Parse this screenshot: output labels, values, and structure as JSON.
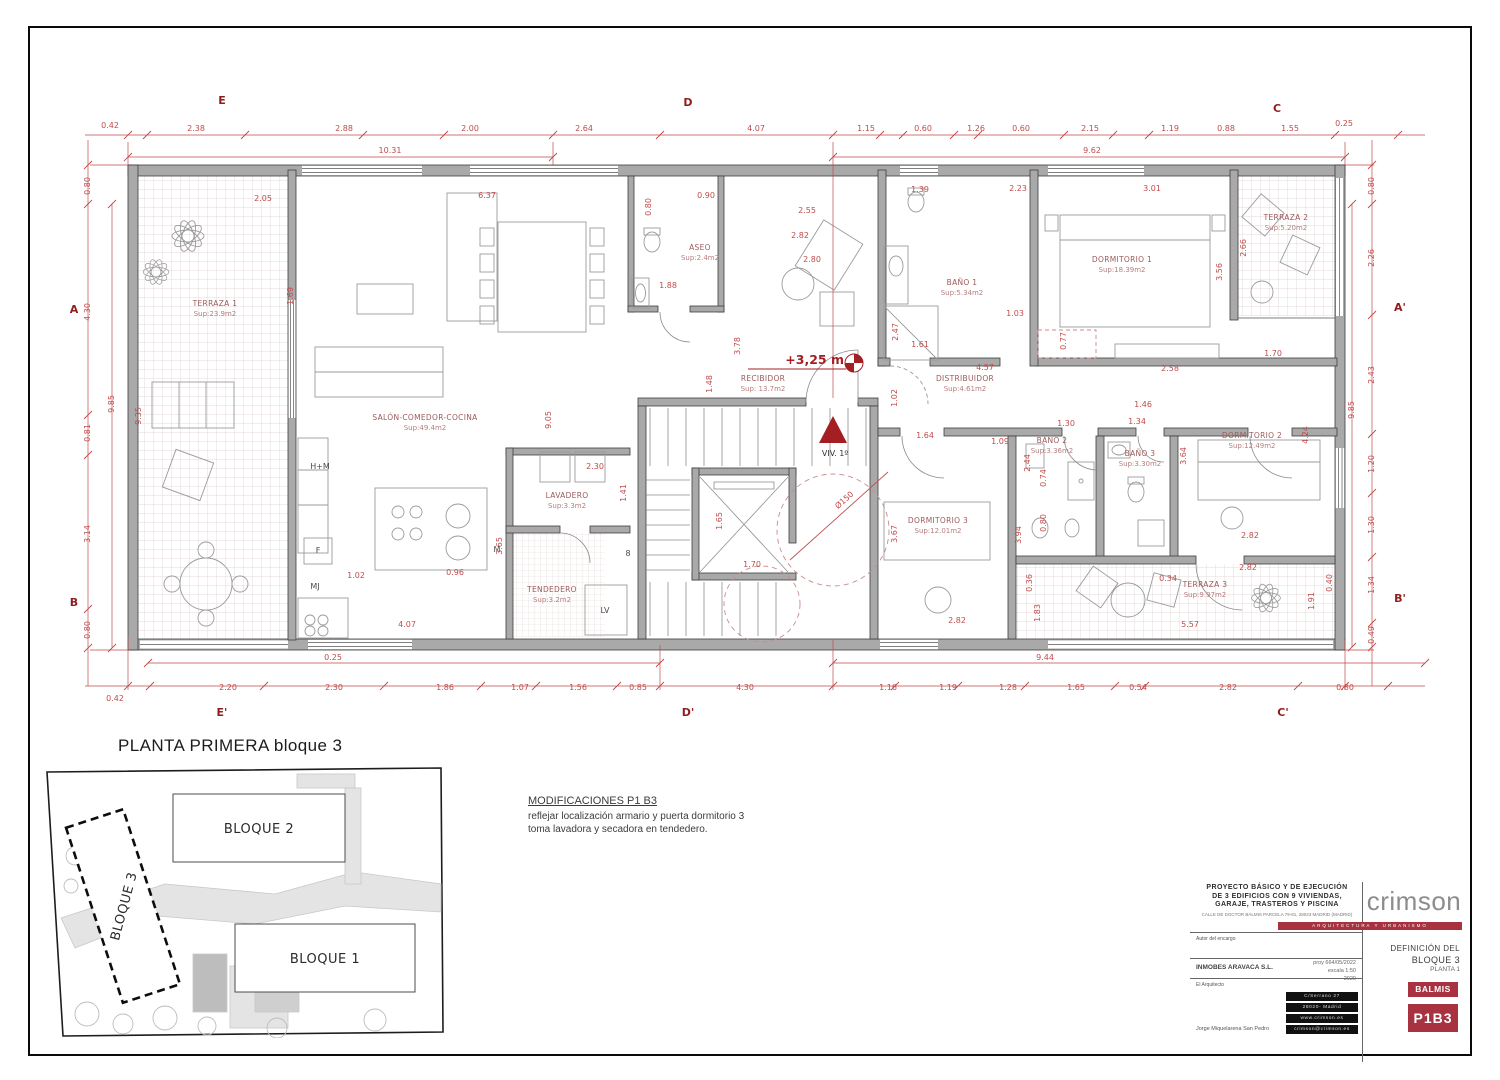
{
  "title": "PLANTA PRIMERA bloque 3",
  "site_map": {
    "bloque1": "BLOQUE 1",
    "bloque2": "BLOQUE 2",
    "bloque3": "BLOQUE 3"
  },
  "modifications": {
    "heading": "MODIFICACIONES P1 B3",
    "line1": "reflejar localización  armario y puerta dormitorio 3",
    "line2": "toma lavadora y secadora en tendedero."
  },
  "title_block": {
    "accent": "#a93241",
    "project_line1": "PROYECTO   BÁSICO Y DE EJECUCIÓN",
    "project_line2": "DE 3 EDIFICIOS CON  9  VIVIENDAS,",
    "project_line3": "GARAJE, TRASTEROS Y PISCINA",
    "project_address": "CALLE DE DOCTOR BALMIS PARCELA 79-81, 28023  MADRID (MADRID)",
    "client_label": "Autor del encargo",
    "client": "INMOBES ARAVACA S.L.",
    "architect_label": "El Arquitecto",
    "architect": "Jorge Miquelarena San Pedro",
    "ref": "proy 664/05/2022",
    "scale": "escala 1:50",
    "year": "2020",
    "address_box": [
      "C/Serrano  27",
      "28020- Madrid",
      "www.crimson.es",
      "crimson@crimson.es"
    ],
    "brand": "crimson",
    "brand_tagline": "ARQUITECTURA Y URBANISMO",
    "definition_line1": "DEFINICIÓN DEL",
    "definition_line2": "BLOQUE 3",
    "definition_line3": "PLANTA 1",
    "badge_top": "BALMIS",
    "badge_bottom": "P1B3"
  },
  "plan": {
    "level_marker": "+3,25 m",
    "unit_marker": "VIV. 1º",
    "rooms": [
      {
        "name": "TERRAZA 1",
        "area": "Sup:23.9m2",
        "x": 215,
        "y": 306
      },
      {
        "name": "SALÓN-COMEDOR-COCINA",
        "area": "Sup:49.4m2",
        "x": 425,
        "y": 420
      },
      {
        "name": "ASEO",
        "area": "Sup:2.4m2",
        "x": 700,
        "y": 250
      },
      {
        "name": "RECIBIDOR",
        "area": "Sup: 13.7m2",
        "x": 763,
        "y": 381
      },
      {
        "name": "DISTRIBUIDOR",
        "area": "Sup:4.61m2",
        "x": 965,
        "y": 381
      },
      {
        "name": "BAÑO 1",
        "area": "Sup:5.34m2",
        "x": 962,
        "y": 285
      },
      {
        "name": "DORMITORIO 1",
        "area": "Sup:18.39m2",
        "x": 1122,
        "y": 262
      },
      {
        "name": "TERRAZA 2",
        "area": "Sup:5.20m2",
        "x": 1286,
        "y": 220
      },
      {
        "name": "DORMITORIO 3",
        "area": "Sup:12.01m2",
        "x": 938,
        "y": 523
      },
      {
        "name": "BAÑO 2",
        "area": "Sup:3.36m2",
        "x": 1052,
        "y": 443
      },
      {
        "name": "BAÑO 3",
        "area": "Sup:3.30m2",
        "x": 1140,
        "y": 456
      },
      {
        "name": "DORMITORIO 2",
        "area": "Sup:12.49m2",
        "x": 1252,
        "y": 438
      },
      {
        "name": "TERRAZA 3",
        "area": "Sup:9.97m2",
        "x": 1205,
        "y": 587
      },
      {
        "name": "LAVADERO",
        "area": "Sup:3.3m2",
        "x": 567,
        "y": 498
      },
      {
        "name": "TENDEDERO",
        "area": "Sup:3.2m2",
        "x": 552,
        "y": 592
      }
    ],
    "appliances": [
      {
        "t": "H+M",
        "x": 320,
        "y": 469
      },
      {
        "t": "F",
        "x": 318,
        "y": 553
      },
      {
        "t": "MJ",
        "x": 315,
        "y": 589
      },
      {
        "t": "M",
        "x": 497,
        "y": 552
      },
      {
        "t": "LV",
        "x": 605,
        "y": 613
      },
      {
        "t": "8",
        "x": 628,
        "y": 556
      }
    ],
    "section_letters": [
      {
        "t": "E",
        "x": 222,
        "y": 104
      },
      {
        "t": "D",
        "x": 688,
        "y": 106
      },
      {
        "t": "C",
        "x": 1277,
        "y": 112
      },
      {
        "t": "E'",
        "x": 222,
        "y": 716
      },
      {
        "t": "D'",
        "x": 688,
        "y": 716
      },
      {
        "t": "C'",
        "x": 1283,
        "y": 716
      },
      {
        "t": "A",
        "x": 74,
        "y": 313
      },
      {
        "t": "B",
        "x": 74,
        "y": 606
      },
      {
        "t": "A'",
        "x": 1400,
        "y": 311
      },
      {
        "t": "B'",
        "x": 1400,
        "y": 602
      }
    ],
    "dims": [
      {
        "t": "0.42",
        "x": 110,
        "y": 128
      },
      {
        "t": "2.38",
        "x": 196,
        "y": 131
      },
      {
        "t": "2.88",
        "x": 344,
        "y": 131
      },
      {
        "t": "2.00",
        "x": 470,
        "y": 131
      },
      {
        "t": "2.64",
        "x": 584,
        "y": 131
      },
      {
        "t": "4.07",
        "x": 756,
        "y": 131
      },
      {
        "t": "1.15",
        "x": 866,
        "y": 131
      },
      {
        "t": "0.60",
        "x": 923,
        "y": 131
      },
      {
        "t": "1.26",
        "x": 976,
        "y": 131
      },
      {
        "t": "0.60",
        "x": 1021,
        "y": 131
      },
      {
        "t": "2.15",
        "x": 1090,
        "y": 131
      },
      {
        "t": "1.19",
        "x": 1170,
        "y": 131
      },
      {
        "t": "0.88",
        "x": 1226,
        "y": 131
      },
      {
        "t": "1.55",
        "x": 1290,
        "y": 131
      },
      {
        "t": "0.25",
        "x": 1344,
        "y": 126
      },
      {
        "t": "10.31",
        "x": 390,
        "y": 153
      },
      {
        "t": "9.62",
        "x": 1092,
        "y": 153
      },
      {
        "t": "0.42",
        "x": 115,
        "y": 701
      },
      {
        "t": "2.20",
        "x": 228,
        "y": 690
      },
      {
        "t": "2.30",
        "x": 334,
        "y": 690
      },
      {
        "t": "1.86",
        "x": 445,
        "y": 690
      },
      {
        "t": "1.07",
        "x": 520,
        "y": 690
      },
      {
        "t": "1.56",
        "x": 578,
        "y": 690
      },
      {
        "t": "0.85",
        "x": 638,
        "y": 690
      },
      {
        "t": "4.30",
        "x": 745,
        "y": 690
      },
      {
        "t": "1.16",
        "x": 888,
        "y": 690
      },
      {
        "t": "1.19",
        "x": 948,
        "y": 690
      },
      {
        "t": "1.28",
        "x": 1008,
        "y": 690
      },
      {
        "t": "1.65",
        "x": 1076,
        "y": 690
      },
      {
        "t": "0.54",
        "x": 1138,
        "y": 690
      },
      {
        "t": "2.82",
        "x": 1228,
        "y": 690
      },
      {
        "t": "0.80",
        "x": 1345,
        "y": 690
      },
      {
        "t": "0.25",
        "x": 333,
        "y": 660
      },
      {
        "t": "9.44",
        "x": 1045,
        "y": 660
      },
      {
        "t": "0.80",
        "x": 90,
        "y": 186,
        "r": -90
      },
      {
        "t": "4.30",
        "x": 90,
        "y": 312,
        "r": -90
      },
      {
        "t": "0.81",
        "x": 90,
        "y": 433,
        "r": -90
      },
      {
        "t": "3.14",
        "x": 90,
        "y": 534,
        "r": -90
      },
      {
        "t": "0.80",
        "x": 90,
        "y": 630,
        "r": -90
      },
      {
        "t": "9.85",
        "x": 114,
        "y": 404,
        "r": -90
      },
      {
        "t": "0.80",
        "x": 1374,
        "y": 186,
        "r": -90
      },
      {
        "t": "2.26",
        "x": 1374,
        "y": 258,
        "r": -90
      },
      {
        "t": "2.43",
        "x": 1374,
        "y": 375,
        "r": -90
      },
      {
        "t": "1.20",
        "x": 1374,
        "y": 464,
        "r": -90
      },
      {
        "t": "1.30",
        "x": 1374,
        "y": 525,
        "r": -90
      },
      {
        "t": "1.34",
        "x": 1374,
        "y": 585,
        "r": -90
      },
      {
        "t": "0.49",
        "x": 1374,
        "y": 635,
        "r": -90
      },
      {
        "t": "9.85",
        "x": 1354,
        "y": 410,
        "r": -90
      },
      {
        "t": "2.05",
        "x": 263,
        "y": 201
      },
      {
        "t": "6.37",
        "x": 487,
        "y": 198
      },
      {
        "t": "9.35",
        "x": 141,
        "y": 416,
        "r": -90
      },
      {
        "t": "9.05",
        "x": 551,
        "y": 420,
        "r": -90
      },
      {
        "t": "1.69",
        "x": 293,
        "y": 296,
        "r": -90
      },
      {
        "t": "0.80",
        "x": 651,
        "y": 207,
        "r": -90
      },
      {
        "t": "0.90",
        "x": 706,
        "y": 198
      },
      {
        "t": "2.55",
        "x": 807,
        "y": 213
      },
      {
        "t": "2.82",
        "x": 800,
        "y": 238
      },
      {
        "t": "2.80",
        "x": 812,
        "y": 262
      },
      {
        "t": "1.88",
        "x": 668,
        "y": 288
      },
      {
        "t": "3.78",
        "x": 740,
        "y": 346,
        "r": -90
      },
      {
        "t": "1.48",
        "x": 712,
        "y": 384,
        "r": -90
      },
      {
        "t": "1.39",
        "x": 920,
        "y": 192
      },
      {
        "t": "2.23",
        "x": 1018,
        "y": 191
      },
      {
        "t": "3.01",
        "x": 1152,
        "y": 191
      },
      {
        "t": "2.47",
        "x": 898,
        "y": 332,
        "r": -90
      },
      {
        "t": "1.61",
        "x": 920,
        "y": 347
      },
      {
        "t": "1.03",
        "x": 1015,
        "y": 316
      },
      {
        "t": "0.77",
        "x": 1066,
        "y": 341,
        "r": -90
      },
      {
        "t": "3.56",
        "x": 1222,
        "y": 272,
        "r": -90
      },
      {
        "t": "2.66",
        "x": 1246,
        "y": 248,
        "r": -90
      },
      {
        "t": "4.57",
        "x": 985,
        "y": 370
      },
      {
        "t": "2.58",
        "x": 1170,
        "y": 371
      },
      {
        "t": "1.70",
        "x": 1273,
        "y": 356
      },
      {
        "t": "1.02",
        "x": 897,
        "y": 398,
        "r": -90
      },
      {
        "t": "1.64",
        "x": 925,
        "y": 438
      },
      {
        "t": "1.09",
        "x": 1000,
        "y": 444
      },
      {
        "t": "1.30",
        "x": 1066,
        "y": 426
      },
      {
        "t": "1.34",
        "x": 1137,
        "y": 424
      },
      {
        "t": "1.46",
        "x": 1143,
        "y": 407
      },
      {
        "t": "3.64",
        "x": 1186,
        "y": 456,
        "r": -90
      },
      {
        "t": "4.24",
        "x": 1308,
        "y": 435,
        "r": -90
      },
      {
        "t": "2.44",
        "x": 1030,
        "y": 463,
        "r": -90
      },
      {
        "t": "0.74",
        "x": 1046,
        "y": 478,
        "r": -90
      },
      {
        "t": "0.80",
        "x": 1046,
        "y": 523,
        "r": -90
      },
      {
        "t": "3.94",
        "x": 1021,
        "y": 535,
        "r": -90
      },
      {
        "t": "3.67",
        "x": 897,
        "y": 534,
        "r": -90
      },
      {
        "t": "2.82",
        "x": 1250,
        "y": 538
      },
      {
        "t": "2.82",
        "x": 1248,
        "y": 570
      },
      {
        "t": "2.82",
        "x": 957,
        "y": 623
      },
      {
        "t": "0.36",
        "x": 1032,
        "y": 583,
        "r": -90
      },
      {
        "t": "0.34",
        "x": 1168,
        "y": 581
      },
      {
        "t": "0.40",
        "x": 1332,
        "y": 583,
        "r": -90
      },
      {
        "t": "1.83",
        "x": 1040,
        "y": 613,
        "r": -90
      },
      {
        "t": "5.57",
        "x": 1190,
        "y": 627
      },
      {
        "t": "1.91",
        "x": 1314,
        "y": 601,
        "r": -90
      },
      {
        "t": "1.65",
        "x": 722,
        "y": 521,
        "r": -90
      },
      {
        "t": "1.70",
        "x": 752,
        "y": 567
      },
      {
        "t": "Ø150",
        "x": 846,
        "y": 502,
        "r": -42
      },
      {
        "t": "2.30",
        "x": 595,
        "y": 469
      },
      {
        "t": "1.41",
        "x": 626,
        "y": 493,
        "r": -90
      },
      {
        "t": "3.65",
        "x": 502,
        "y": 546,
        "r": -90
      },
      {
        "t": "1.02",
        "x": 356,
        "y": 578
      },
      {
        "t": "0.96",
        "x": 455,
        "y": 575
      },
      {
        "t": "4.07",
        "x": 407,
        "y": 627
      }
    ]
  }
}
